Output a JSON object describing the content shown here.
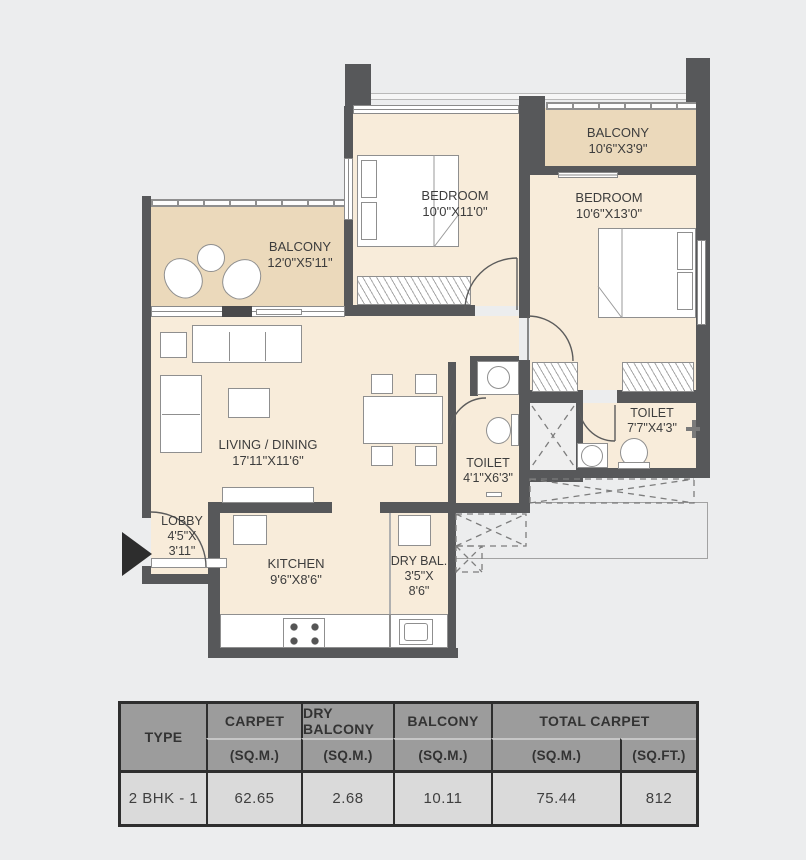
{
  "colors": {
    "background": "#ecedee",
    "wall": "#57585a",
    "room_fill": "#f8ecda",
    "balcony_fill": "#ebd9bb",
    "table_header_bg": "#9c9c9c",
    "table_row_bg": "#dadada",
    "table_border": "#2e2e2e",
    "entrance_arrow": "#2d2d2d"
  },
  "plan": {
    "balcony_top": {
      "name": "BALCONY",
      "dims": "10'6\"X3'9\""
    },
    "bedroom1": {
      "name": "BEDROOM",
      "dims": "10'0\"X11'0\""
    },
    "bedroom2": {
      "name": "BEDROOM",
      "dims": "10'6\"X13'0\""
    },
    "balcony_left": {
      "name": "BALCONY",
      "dims": "12'0\"X5'11\""
    },
    "living": {
      "name": "LIVING / DINING",
      "dims": "17'11\"X11'6\""
    },
    "toilet1": {
      "name": "TOILET",
      "dims": "4'1\"X6'3\""
    },
    "toilet2": {
      "name": "TOILET",
      "dims": "7'7\"X4'3\""
    },
    "lobby": {
      "name": "LOBBY",
      "dims1": "4'5\"X",
      "dims2": "3'11\""
    },
    "kitchen": {
      "name": "KITCHEN",
      "dims": "9'6\"X8'6\""
    },
    "dry_balcony": {
      "name": "DRY BAL.",
      "dims1": "3'5\"X",
      "dims2": "8'6\""
    }
  },
  "table": {
    "col_type": "TYPE",
    "col_carpet": "CARPET",
    "col_dry_balcony": "DRY BALCONY",
    "col_balcony": "BALCONY",
    "col_total_carpet": "TOTAL CARPET",
    "unit_sqm": "(SQ.M.)",
    "unit_sqft": "(SQ.FT.)",
    "row": {
      "type": "2 BHK - 1",
      "carpet_sqm": "62.65",
      "dry_balcony_sqm": "2.68",
      "balcony_sqm": "10.11",
      "total_sqm": "75.44",
      "total_sqft": "812"
    }
  }
}
